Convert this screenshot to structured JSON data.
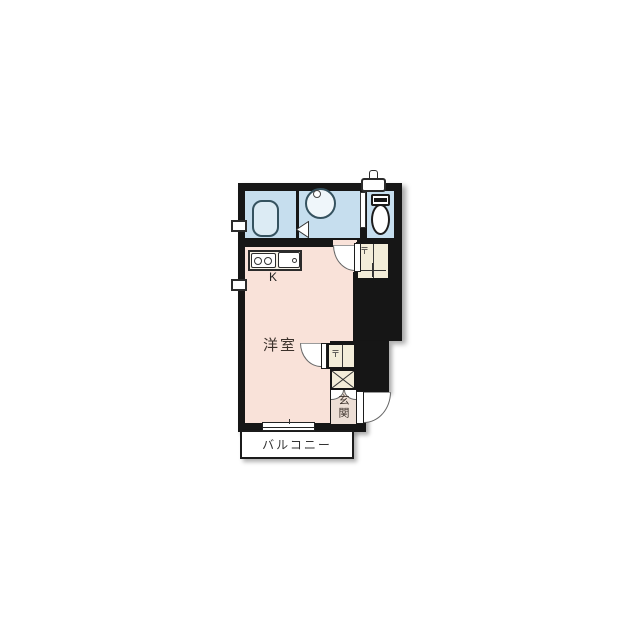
{
  "floor_plan": {
    "room_labels": {
      "kitchen": "K",
      "western_room": "洋室",
      "entrance": "玄関",
      "balcony": "バルコニー"
    },
    "symbols": {
      "closet_shelf_mark": "〒"
    },
    "colors": {
      "wall": "#161616",
      "wet_area_floor": "#c6deee",
      "bathtub": "#dcebf4",
      "western_room_floor": "#f9e2d9",
      "closet_floor": "#f3edd9",
      "entrance_floor": "#eddfd6",
      "fixtures": "#ffffff"
    },
    "fixtures": [
      "bathtub",
      "washbasin",
      "toilet",
      "water-heater",
      "gas-stove",
      "kitchen-sink",
      "closet",
      "shoe-cabinet",
      "swing-doors",
      "sliding-window",
      "small-windows",
      "balcony"
    ]
  }
}
